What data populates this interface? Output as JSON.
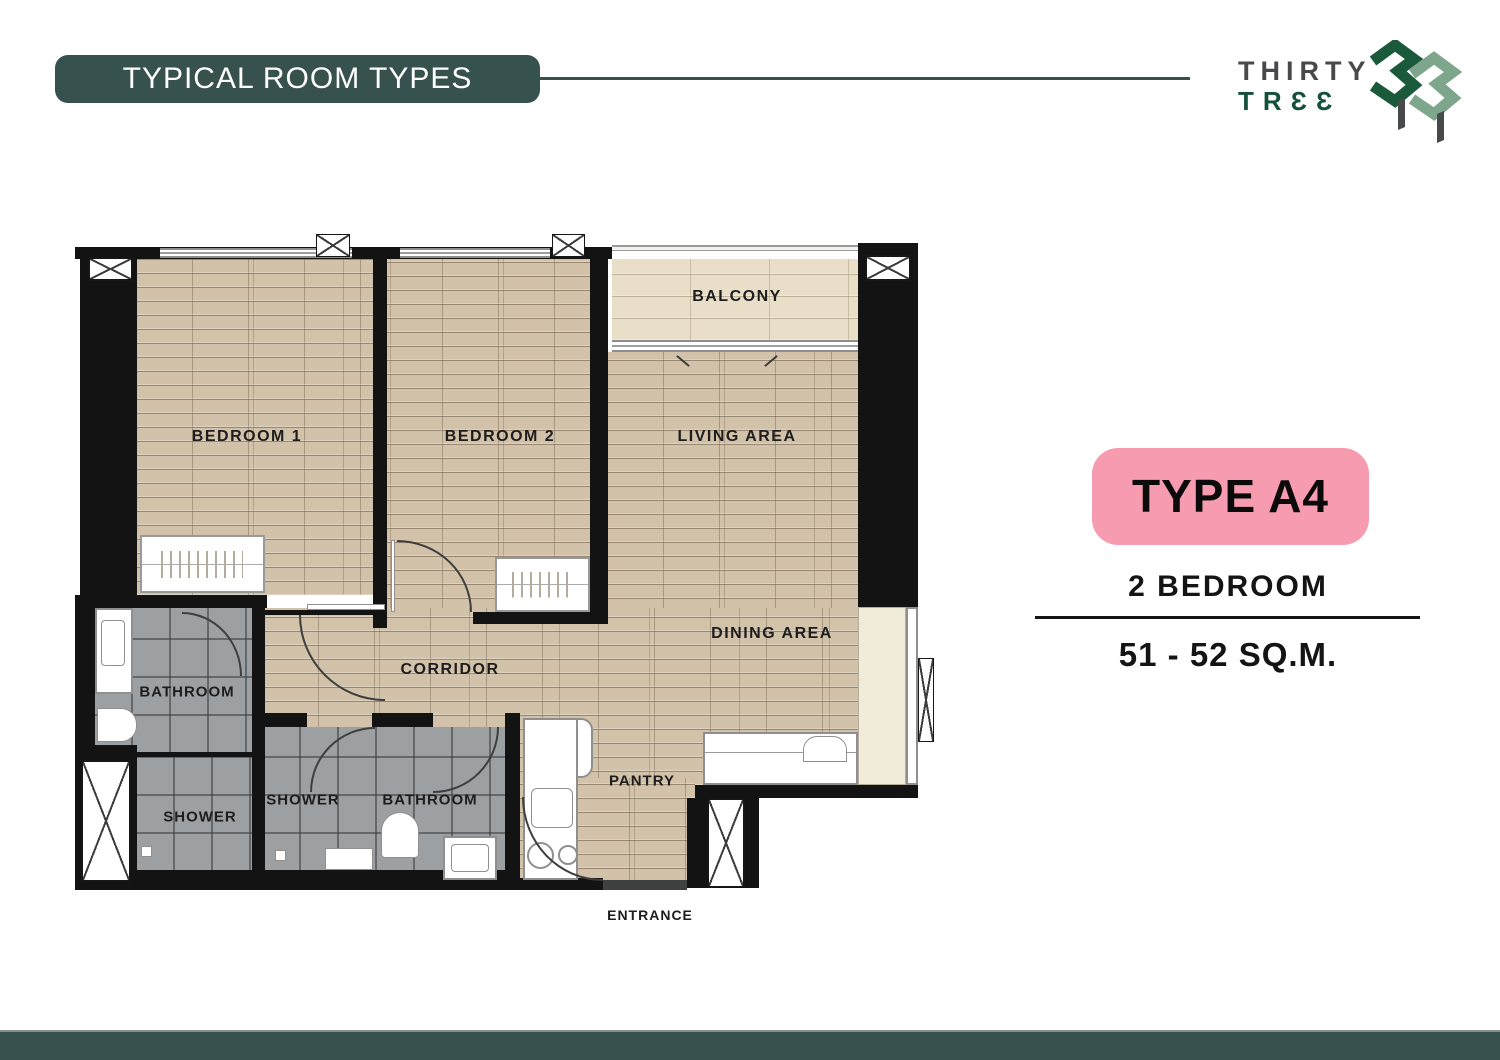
{
  "header": {
    "title": "TYPICAL ROOM TYPES"
  },
  "brand": {
    "word1": "THIRTY",
    "word2": "TRƐƐ"
  },
  "info_panel": {
    "type_badge": "TYPE A4",
    "bedrooms": "2 BEDROOM",
    "area": "51 - 52 SQ.M."
  },
  "floorplan": {
    "labels": {
      "bedroom1": "BEDROOM 1",
      "bedroom2": "BEDROOM 2",
      "living": "LIVING AREA",
      "balcony": "BALCONY",
      "dining": "DINING AREA",
      "corridor": "CORRIDOR",
      "bathroom1": "BATHROOM",
      "shower1": "SHOWER",
      "shower2": "SHOWER",
      "bathroom2": "BATHROOM",
      "pantry": "PANTRY",
      "entrance": "ENTRANCE"
    }
  },
  "colors": {
    "teal": "#37514F",
    "pink": "#F79CB0",
    "green_dark": "#1A5A3B",
    "green_sage": "#7DA68C",
    "logo_gray": "#48494B",
    "wall": "#131313",
    "wood": "#D2C2AA",
    "wood_light": "#E9DFC9",
    "tile": "#9DA0A2",
    "cream": "#F2ECDA"
  }
}
